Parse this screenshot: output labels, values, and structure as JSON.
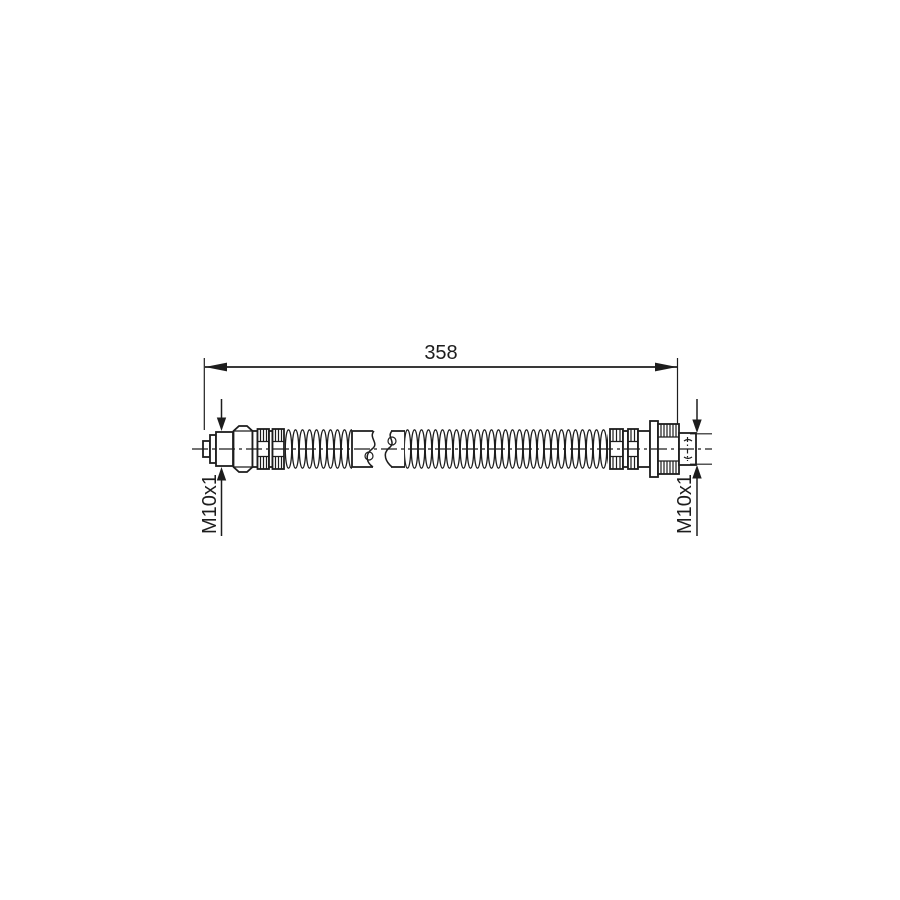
{
  "drawing": {
    "type": "technical-line-drawing",
    "subject": "brake-hose-side-view",
    "dimension": {
      "length_label": "358"
    },
    "threads": {
      "left_label": "M10x1",
      "right_label": "M10x1"
    }
  },
  "colors": {
    "ink": "#1d1d1d",
    "background": "#ffffff"
  }
}
